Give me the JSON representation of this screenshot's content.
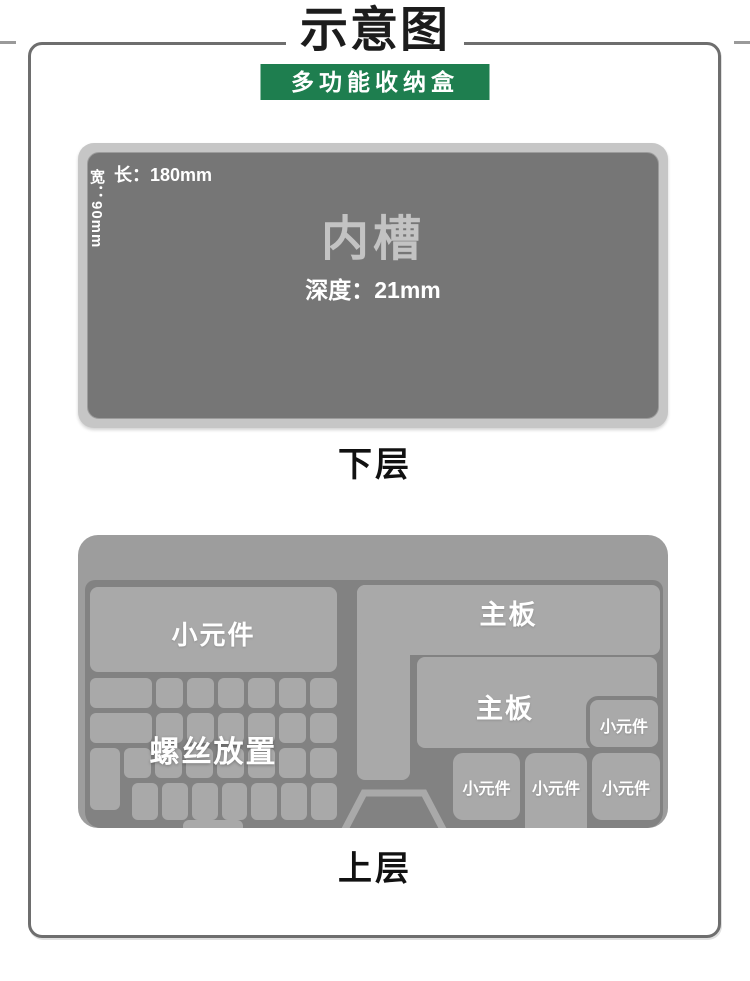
{
  "header": {
    "title": "示意图",
    "subtitle": "多功能收纳盒",
    "banner_color": "#1e7e4f"
  },
  "lower_layer": {
    "caption": "下层",
    "slot_name": "内槽",
    "length_label": "长：180mm",
    "width_label": "宽：90mm",
    "depth_label": "深度：21mm"
  },
  "upper_layer": {
    "caption": "上层",
    "compartments": {
      "small_parts_large": "小元件",
      "screws_area": "螺丝放置",
      "mainboard_top": "主板",
      "mainboard_middle": "主板",
      "small_parts_right": "小元件",
      "small_parts_bottom": [
        "小元件",
        "小元件",
        "小元件"
      ]
    },
    "screw_grid": {
      "rows": [
        {
          "lead": "wide",
          "cells": 6
        },
        {
          "lead": "wide",
          "cells": 6
        },
        {
          "lead": "spacer",
          "cells": 7
        },
        {
          "lead": "none",
          "cells": 7
        }
      ]
    }
  },
  "colors": {
    "tray_surface": "#9d9d9d",
    "tray_well": "#828282",
    "compartment": "#a9a9a9",
    "lower_box_rim": "#c6c6c6",
    "lower_box_inner": "#767676"
  }
}
